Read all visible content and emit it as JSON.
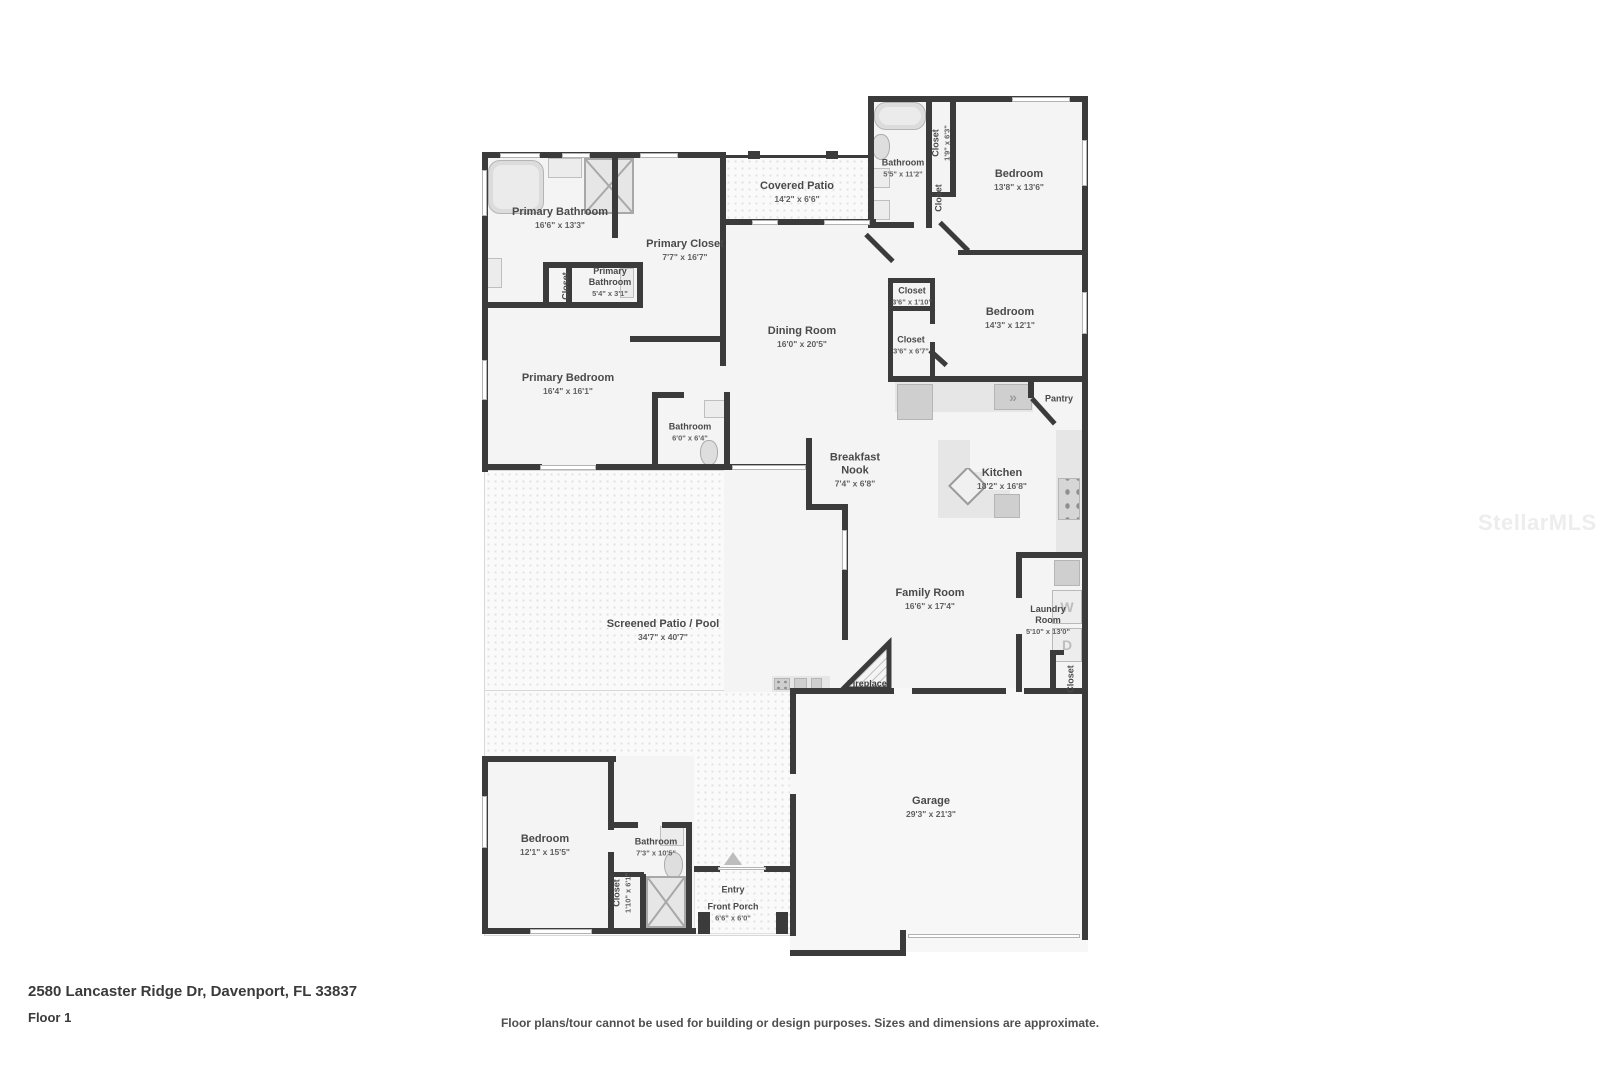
{
  "watermark": "StellarMLS",
  "footer": {
    "address": "2580 Lancaster Ridge Dr, Davenport, FL 33837",
    "floor": "Floor 1",
    "disclaimer": "Floor plans/tour cannot be used for building or design purposes. Sizes and dimensions are approximate."
  },
  "appliances": {
    "washer": "W",
    "dryer": "D",
    "range_icon": "»"
  },
  "colors": {
    "wall": "#3b3b3b",
    "room_fill": "#f4f4f4",
    "label": "#4a4a4a"
  },
  "rooms": {
    "primary_bathroom": {
      "name": "Primary Bathroom",
      "dims": "16'6\" x 13'3\""
    },
    "primary_closet": {
      "name": "Primary Closet",
      "dims": "7'7\" x 16'7\""
    },
    "primary_closet_small": {
      "name": "Closet"
    },
    "primary_bathroom_2": {
      "name": "Primary\nBathroom",
      "dims": "5'4\" x 3'1\""
    },
    "covered_patio": {
      "name": "Covered Patio",
      "dims": "14'2\" x 6'6\""
    },
    "bathroom_2": {
      "name": "Bathroom",
      "dims": "5'5\" x 11'2\""
    },
    "closet_hall": {
      "name": "Closet",
      "dims": "1'9\" x 6'3\""
    },
    "closet_bedroom_1": {
      "name": "Closet"
    },
    "bedroom_1": {
      "name": "Bedroom",
      "dims": "13'8\" x 13'6\""
    },
    "closet_small_upper": {
      "name": "Closet",
      "dims": "3'6\" x 1'10\""
    },
    "bedroom_2": {
      "name": "Bedroom",
      "dims": "14'3\" x 12'1\""
    },
    "closet_small_lower": {
      "name": "Closet",
      "dims": "3'6\" x 6'7\""
    },
    "dining_room": {
      "name": "Dining Room",
      "dims": "16'0\" x 20'5\""
    },
    "pantry": {
      "name": "Pantry"
    },
    "primary_bedroom": {
      "name": "Primary Bedroom",
      "dims": "16'4\" x 16'1\""
    },
    "bathroom_hall": {
      "name": "Bathroom",
      "dims": "6'0\" x 6'4\""
    },
    "breakfast_nook": {
      "name": "Breakfast\nNook",
      "dims": "7'4\" x 6'8\""
    },
    "kitchen": {
      "name": "Kitchen",
      "dims": "18'2\" x 16'8\""
    },
    "family_room": {
      "name": "Family Room",
      "dims": "16'6\" x 17'4\""
    },
    "laundry_room": {
      "name": "Laundry\nRoom",
      "dims": "5'10\" x 13'0\""
    },
    "closet_laundry": {
      "name": "Closet"
    },
    "fireplace": {
      "name": "Fireplace"
    },
    "screened_patio": {
      "name": "Screened Patio / Pool",
      "dims": "34'7\" x 40'7\""
    },
    "bedroom_3": {
      "name": "Bedroom",
      "dims": "12'1\" x 15'5\""
    },
    "bathroom_3": {
      "name": "Bathroom",
      "dims": "7'3\" x 10'5\""
    },
    "closet_bedroom_3": {
      "name": "Closet",
      "dims": "1'10\" x 6'1\""
    },
    "entry": {
      "name": "Entry"
    },
    "front_porch": {
      "name": "Front Porch",
      "dims": "6'6\" x 6'0\""
    },
    "garage": {
      "name": "Garage",
      "dims": "29'3\" x 21'3\""
    }
  }
}
